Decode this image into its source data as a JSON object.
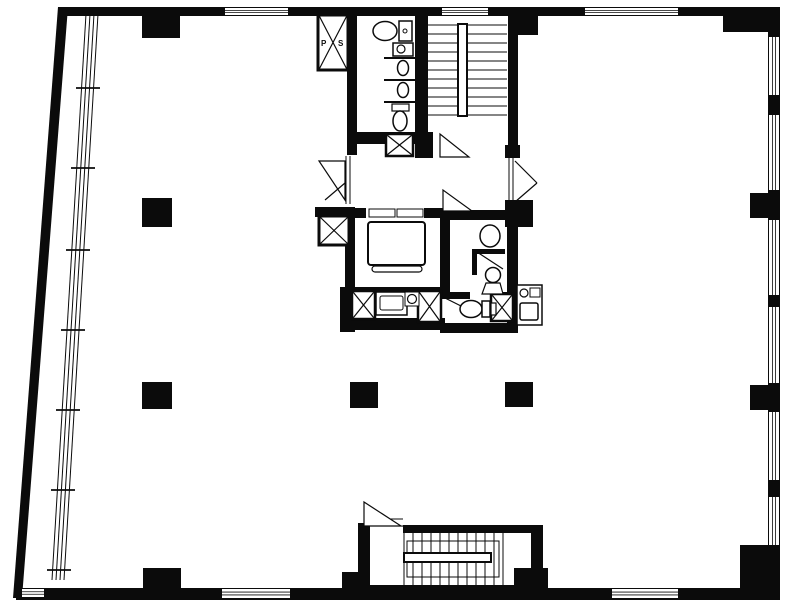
{
  "meta": {
    "title": "Office building floor plan",
    "kind": "architectural-floor-plan"
  },
  "canvas": {
    "width": 787,
    "height": 604,
    "paper": "#ffffff",
    "ink": "#0b0b0b"
  },
  "labels": {
    "shaft_p": "P",
    "shaft_s": "S"
  },
  "shapes": [
    {
      "t": "poly",
      "n": "left-exterior-wall",
      "pts": "58,7 68,7 22,598 13,598"
    },
    {
      "t": "rect",
      "n": "top-exterior-wall",
      "x": 58,
      "y": 7,
      "w": 722,
      "h": 9
    },
    {
      "t": "rect",
      "n": "right-exterior-wall",
      "x": 768,
      "y": 7,
      "w": 12,
      "h": 593
    },
    {
      "t": "rect",
      "n": "bottom-exterior-wall",
      "x": 16,
      "y": 588,
      "w": 764,
      "h": 12
    },
    {
      "t": "winh",
      "n": "window-top-1",
      "x": 225,
      "y": 8,
      "w": 63,
      "h": 7
    },
    {
      "t": "winh",
      "n": "window-top-2",
      "x": 442,
      "y": 8,
      "w": 46,
      "h": 7
    },
    {
      "t": "winh",
      "n": "window-top-3",
      "x": 585,
      "y": 8,
      "w": 93,
      "h": 7
    },
    {
      "t": "winh",
      "n": "window-bottom-1",
      "x": 222,
      "y": 589,
      "w": 68,
      "h": 9
    },
    {
      "t": "winh",
      "n": "window-bottom-2",
      "x": 612,
      "y": 589,
      "w": 66,
      "h": 9
    },
    {
      "t": "winh",
      "n": "window-bottom-corner",
      "x": 22,
      "y": 589,
      "w": 22,
      "h": 8
    },
    {
      "t": "winv",
      "n": "window-right-1",
      "x": 769,
      "y": 37,
      "w": 10,
      "h": 58
    },
    {
      "t": "winv",
      "n": "window-right-2",
      "x": 769,
      "y": 115,
      "w": 10,
      "h": 75
    },
    {
      "t": "winv",
      "n": "window-right-3",
      "x": 769,
      "y": 220,
      "w": 10,
      "h": 75
    },
    {
      "t": "winv",
      "n": "window-right-4",
      "x": 769,
      "y": 307,
      "w": 10,
      "h": 76
    },
    {
      "t": "winv",
      "n": "window-right-5",
      "x": 769,
      "y": 412,
      "w": 10,
      "h": 68
    },
    {
      "t": "winv",
      "n": "window-right-6",
      "x": 769,
      "y": 497,
      "w": 10,
      "h": 48
    },
    {
      "t": "rect",
      "n": "core-wall-left-upper",
      "x": 347,
      "y": 16,
      "w": 10,
      "h": 139
    },
    {
      "t": "rect",
      "n": "core-wall-wc-stair-divider",
      "x": 415,
      "y": 16,
      "w": 13,
      "h": 142
    },
    {
      "t": "rect",
      "n": "core-wall-stair-right",
      "x": 508,
      "y": 16,
      "w": 10,
      "h": 140
    },
    {
      "t": "rect",
      "n": "core-wall-wc-bottom",
      "x": 347,
      "y": 132,
      "w": 86,
      "h": 12
    },
    {
      "t": "rect",
      "n": "core-wall-stub-a",
      "x": 420,
      "y": 144,
      "w": 13,
      "h": 14
    },
    {
      "t": "rect",
      "n": "core-wall-stub-b",
      "x": 505,
      "y": 145,
      "w": 15,
      "h": 13
    },
    {
      "t": "rect",
      "n": "core-wall-cap-west",
      "x": 315,
      "y": 207,
      "w": 40,
      "h": 10
    },
    {
      "t": "rect",
      "n": "core-wall-left-lower",
      "x": 345,
      "y": 207,
      "w": 10,
      "h": 125
    },
    {
      "t": "rect",
      "n": "elevator-wall-top",
      "x": 345,
      "y": 208,
      "w": 105,
      "h": 10
    },
    {
      "t": "rect",
      "n": "elevator-wall-right",
      "x": 440,
      "y": 208,
      "w": 10,
      "h": 89
    },
    {
      "t": "rect",
      "n": "elevator-wall-bottom",
      "x": 345,
      "y": 287,
      "w": 105,
      "h": 10
    },
    {
      "t": "rect",
      "n": "washroom-wall-top",
      "x": 447,
      "y": 210,
      "w": 60,
      "h": 10
    },
    {
      "t": "rect",
      "n": "corridor-corner-column",
      "x": 505,
      "y": 200,
      "w": 28,
      "h": 27
    },
    {
      "t": "rect",
      "n": "core-wall-right-lower",
      "x": 507,
      "y": 203,
      "w": 11,
      "h": 130
    },
    {
      "t": "rect",
      "n": "core-wall-west-lower",
      "x": 340,
      "y": 287,
      "w": 13,
      "h": 45
    },
    {
      "t": "rect",
      "n": "core-wall-bottom-left",
      "x": 340,
      "y": 318,
      "w": 105,
      "h": 12
    },
    {
      "t": "rect",
      "n": "core-wall-bottom-right",
      "x": 440,
      "y": 323,
      "w": 78,
      "h": 10
    },
    {
      "t": "rect",
      "n": "washroom-partition-h",
      "x": 472,
      "y": 249,
      "w": 33,
      "h": 5
    },
    {
      "t": "rect",
      "n": "washroom-partition-v",
      "x": 472,
      "y": 249,
      "w": 5,
      "h": 26
    },
    {
      "t": "rect",
      "n": "toilet-room-wall-a",
      "x": 440,
      "y": 292,
      "w": 30,
      "h": 7
    },
    {
      "t": "rect",
      "n": "toilet-room-wall-b",
      "x": 490,
      "y": 292,
      "w": 28,
      "h": 7
    },
    {
      "t": "rect",
      "n": "stair-enclosure-wall-left",
      "x": 358,
      "y": 523,
      "w": 12,
      "h": 70
    },
    {
      "t": "rect",
      "n": "stair-enclosure-wall-top",
      "x": 403,
      "y": 525,
      "w": 140,
      "h": 8
    },
    {
      "t": "rect",
      "n": "stair-enclosure-wall-right",
      "x": 531,
      "y": 533,
      "w": 12,
      "h": 57
    },
    {
      "t": "rect",
      "n": "stair-enclosure-wall-bottom",
      "x": 358,
      "y": 585,
      "w": 185,
      "h": 8
    },
    {
      "t": "rect",
      "n": "column-top-a",
      "x": 142,
      "y": 16,
      "w": 38,
      "h": 22
    },
    {
      "t": "rect",
      "n": "column-top-b",
      "x": 508,
      "y": 16,
      "w": 30,
      "h": 19
    },
    {
      "t": "rect",
      "n": "corner-column-top-right",
      "x": 723,
      "y": 7,
      "w": 57,
      "h": 25
    },
    {
      "t": "rect",
      "n": "column-right-a",
      "x": 750,
      "y": 193,
      "w": 30,
      "h": 25
    },
    {
      "t": "rect",
      "n": "column-right-b",
      "x": 750,
      "y": 385,
      "w": 30,
      "h": 25
    },
    {
      "t": "rect",
      "n": "corner-column-bottom-right",
      "x": 740,
      "y": 545,
      "w": 40,
      "h": 55
    },
    {
      "t": "rect",
      "n": "column-free-left-a",
      "x": 142,
      "y": 198,
      "w": 30,
      "h": 29
    },
    {
      "t": "rect",
      "n": "column-free-left-b",
      "x": 142,
      "y": 382,
      "w": 30,
      "h": 27
    },
    {
      "t": "rect",
      "n": "column-free-center",
      "x": 350,
      "y": 382,
      "w": 28,
      "h": 26
    },
    {
      "t": "rect",
      "n": "column-free-right",
      "x": 505,
      "y": 382,
      "w": 28,
      "h": 25
    },
    {
      "t": "rect",
      "n": "column-bottom-a",
      "x": 143,
      "y": 568,
      "w": 38,
      "h": 22
    },
    {
      "t": "rect",
      "n": "column-bottom-stair-left",
      "x": 342,
      "y": 572,
      "w": 26,
      "h": 18
    },
    {
      "t": "rect",
      "n": "column-bottom-stair-right",
      "x": 514,
      "y": 568,
      "w": 34,
      "h": 22
    },
    {
      "t": "line",
      "n": "stair-tread",
      "x1": 428,
      "y1": 25,
      "x2": 507,
      "y2": 25,
      "sw": 1
    },
    {
      "t": "line",
      "n": "stair-tread",
      "x1": 428,
      "y1": 34,
      "x2": 507,
      "y2": 34,
      "sw": 1
    },
    {
      "t": "line",
      "n": "stair-tread",
      "x1": 428,
      "y1": 43,
      "x2": 507,
      "y2": 43,
      "sw": 1
    },
    {
      "t": "line",
      "n": "stair-tread",
      "x1": 428,
      "y1": 52,
      "x2": 507,
      "y2": 52,
      "sw": 1
    },
    {
      "t": "line",
      "n": "stair-tread",
      "x1": 428,
      "y1": 61,
      "x2": 507,
      "y2": 61,
      "sw": 1
    },
    {
      "t": "line",
      "n": "stair-tread",
      "x1": 428,
      "y1": 70,
      "x2": 507,
      "y2": 70,
      "sw": 1
    },
    {
      "t": "line",
      "n": "stair-tread",
      "x1": 428,
      "y1": 79,
      "x2": 507,
      "y2": 79,
      "sw": 1
    },
    {
      "t": "line",
      "n": "stair-tread",
      "x1": 428,
      "y1": 88,
      "x2": 507,
      "y2": 88,
      "sw": 1
    },
    {
      "t": "line",
      "n": "stair-tread",
      "x1": 428,
      "y1": 97,
      "x2": 507,
      "y2": 97,
      "sw": 1
    },
    {
      "t": "line",
      "n": "stair-tread",
      "x1": 428,
      "y1": 106,
      "x2": 507,
      "y2": 106,
      "sw": 1
    },
    {
      "t": "line",
      "n": "stair-tread",
      "x1": 428,
      "y1": 115,
      "x2": 507,
      "y2": 115,
      "sw": 1
    },
    {
      "t": "wrect",
      "n": "stair-rail-upper",
      "x": 458,
      "y": 24,
      "w": 9,
      "h": 92,
      "sw": 2
    },
    {
      "t": "wpoly",
      "n": "door-stair-landing",
      "pts": "440,134 440,157 469,157",
      "sw": 1.2
    },
    {
      "t": "orect",
      "n": "stair-flight-outline",
      "x": 407,
      "y": 541,
      "w": 92,
      "h": 36,
      "sw": 1
    },
    {
      "t": "line",
      "n": "stair-tread-lower",
      "x1": 404,
      "y1": 533,
      "x2": 404,
      "y2": 585,
      "sw": 1
    },
    {
      "t": "line",
      "n": "stair-tread-lower",
      "x1": 413,
      "y1": 533,
      "x2": 413,
      "y2": 585,
      "sw": 1
    },
    {
      "t": "line",
      "n": "stair-tread-lower",
      "x1": 422,
      "y1": 533,
      "x2": 422,
      "y2": 585,
      "sw": 1
    },
    {
      "t": "line",
      "n": "stair-tread-lower",
      "x1": 431,
      "y1": 533,
      "x2": 431,
      "y2": 585,
      "sw": 1
    },
    {
      "t": "line",
      "n": "stair-tread-lower",
      "x1": 440,
      "y1": 533,
      "x2": 440,
      "y2": 585,
      "sw": 1
    },
    {
      "t": "line",
      "n": "stair-tread-lower",
      "x1": 449,
      "y1": 533,
      "x2": 449,
      "y2": 585,
      "sw": 1
    },
    {
      "t": "line",
      "n": "stair-tread-lower",
      "x1": 458,
      "y1": 533,
      "x2": 458,
      "y2": 585,
      "sw": 1
    },
    {
      "t": "line",
      "n": "stair-tread-lower",
      "x1": 467,
      "y1": 533,
      "x2": 467,
      "y2": 585,
      "sw": 1
    },
    {
      "t": "line",
      "n": "stair-tread-lower",
      "x1": 476,
      "y1": 533,
      "x2": 476,
      "y2": 585,
      "sw": 1
    },
    {
      "t": "line",
      "n": "stair-tread-lower",
      "x1": 485,
      "y1": 533,
      "x2": 485,
      "y2": 585,
      "sw": 1
    },
    {
      "t": "line",
      "n": "stair-tread-lower",
      "x1": 494,
      "y1": 533,
      "x2": 494,
      "y2": 585,
      "sw": 1
    },
    {
      "t": "line",
      "n": "stair-tread-lower",
      "x1": 503,
      "y1": 533,
      "x2": 503,
      "y2": 585,
      "sw": 1
    },
    {
      "t": "wrect",
      "n": "stair-rail-lower",
      "x": 404,
      "y": 553,
      "w": 87,
      "h": 9,
      "sw": 2
    },
    {
      "t": "line",
      "n": "stair-door-sill",
      "x1": 366,
      "y1": 519,
      "x2": 403,
      "y2": 519,
      "sw": 1
    },
    {
      "t": "line",
      "n": "stair-door-sill",
      "x1": 366,
      "y1": 526,
      "x2": 403,
      "y2": 526,
      "sw": 1
    },
    {
      "t": "wpoly",
      "n": "door-stair-lower",
      "pts": "364,502 364,526 401,526",
      "sw": 1.2
    },
    {
      "t": "wrect",
      "n": "elevator-door-opening",
      "x": 366,
      "y": 208,
      "w": 58,
      "h": 10,
      "sw": 0
    },
    {
      "t": "orect",
      "n": "elevator-door-panel-left",
      "x": 369,
      "y": 209,
      "w": 26,
      "h": 8,
      "sw": 1
    },
    {
      "t": "orect",
      "n": "elevator-door-panel-right",
      "x": 397,
      "y": 209,
      "w": 26,
      "h": 8,
      "sw": 1
    },
    {
      "t": "wrect",
      "n": "elevator-car",
      "x": 368,
      "y": 222,
      "w": 57,
      "h": 43,
      "sw": 2,
      "rx": 3
    },
    {
      "t": "wrect",
      "n": "elevator-sill",
      "x": 372,
      "y": 266,
      "w": 50,
      "h": 6,
      "sw": 1.2,
      "rx": 3
    },
    {
      "t": "xbox",
      "n": "pipe-shaft-ps",
      "x": 318,
      "y": 15,
      "w": 30,
      "h": 55,
      "sw": 3
    },
    {
      "t": "xbox",
      "n": "duct-shaft-a",
      "x": 386,
      "y": 134,
      "w": 27,
      "h": 22,
      "sw": 2.5
    },
    {
      "t": "xbox",
      "n": "pipe-shaft-b",
      "x": 319,
      "y": 216,
      "w": 30,
      "h": 29,
      "sw": 3
    },
    {
      "t": "xbox",
      "n": "duct-shaft-c",
      "x": 352,
      "y": 291,
      "w": 23,
      "h": 28,
      "sw": 2.5
    },
    {
      "t": "xbox",
      "n": "duct-shaft-d",
      "x": 418,
      "y": 291,
      "w": 23,
      "h": 31,
      "sw": 2.5
    },
    {
      "t": "xbox",
      "n": "duct-shaft-e",
      "x": 491,
      "y": 294,
      "w": 22,
      "h": 27,
      "sw": 2.5
    },
    {
      "t": "text",
      "n": "shaft-label-p",
      "x": 321,
      "y": 46,
      "s": 8,
      "text": "P"
    },
    {
      "t": "text",
      "n": "shaft-label-s",
      "x": 338,
      "y": 46,
      "s": 8,
      "text": "S"
    },
    {
      "t": "ell",
      "n": "toilet-bowl-1",
      "cx": 385,
      "cy": 31,
      "rx": 12,
      "ry": 9.5,
      "sw": 1.5
    },
    {
      "t": "wrect",
      "n": "toilet-tank-1",
      "x": 399,
      "y": 21,
      "w": 13,
      "h": 20,
      "sw": 1.5
    },
    {
      "t": "circ",
      "n": "toilet-flush-1",
      "cx": 405,
      "cy": 31,
      "r": 2,
      "sw": 1
    },
    {
      "t": "wrect",
      "n": "lavatory-sink",
      "x": 393,
      "y": 43,
      "w": 20,
      "h": 13,
      "sw": 1.5
    },
    {
      "t": "circ",
      "n": "lavatory-basin",
      "cx": 401,
      "cy": 49,
      "r": 4,
      "sw": 1.2
    },
    {
      "t": "line",
      "n": "urinal-partition",
      "x1": 384,
      "y1": 58,
      "x2": 415,
      "y2": 58,
      "sw": 2
    },
    {
      "t": "ell",
      "n": "urinal-a",
      "cx": 403,
      "cy": 68,
      "rx": 5.5,
      "ry": 7.5,
      "sw": 1.5
    },
    {
      "t": "line",
      "n": "urinal-partition",
      "x1": 384,
      "y1": 80,
      "x2": 415,
      "y2": 80,
      "sw": 2
    },
    {
      "t": "ell",
      "n": "urinal-b",
      "cx": 403,
      "cy": 90,
      "rx": 5.5,
      "ry": 7.5,
      "sw": 1.5
    },
    {
      "t": "line",
      "n": "urinal-partition",
      "x1": 384,
      "y1": 102,
      "x2": 415,
      "y2": 102,
      "sw": 2
    },
    {
      "t": "wrect",
      "n": "toilet-tank-2",
      "x": 392,
      "y": 104,
      "w": 17,
      "h": 7,
      "sw": 1.2
    },
    {
      "t": "ell",
      "n": "toilet-bowl-2",
      "cx": 400,
      "cy": 121,
      "rx": 7,
      "ry": 10,
      "sw": 1.5
    },
    {
      "t": "ell",
      "n": "washbasin",
      "cx": 490,
      "cy": 236,
      "rx": 10,
      "ry": 11,
      "sw": 1.5
    },
    {
      "t": "line",
      "n": "door-leaf-washroom",
      "x1": 477,
      "y1": 252,
      "x2": 503,
      "y2": 269,
      "sw": 1.2
    },
    {
      "t": "circ",
      "n": "wc-front-bowl",
      "cx": 493,
      "cy": 275,
      "r": 7.5,
      "sw": 1.5
    },
    {
      "t": "wpoly",
      "n": "wc-front-base",
      "pts": "482,294 503,294 500,283 486,283",
      "sw": 1.2
    },
    {
      "t": "line",
      "n": "door-leaf-toilet",
      "x1": 441,
      "y1": 296,
      "x2": 467,
      "y2": 309,
      "sw": 1.2
    },
    {
      "t": "ell",
      "n": "toilet-bowl-3",
      "cx": 471,
      "cy": 309,
      "rx": 11,
      "ry": 8.5,
      "sw": 1.5
    },
    {
      "t": "wrect",
      "n": "toilet-tank-3",
      "x": 482,
      "y": 301,
      "w": 8,
      "h": 16,
      "sw": 1.5
    },
    {
      "t": "wrect",
      "n": "toilet-tank-3b",
      "x": 491,
      "y": 303,
      "w": 5,
      "h": 12,
      "sw": 1.2
    },
    {
      "t": "wrect",
      "n": "vanity-counter",
      "x": 376,
      "y": 292,
      "w": 31,
      "h": 23,
      "sw": 1.5
    },
    {
      "t": "orect",
      "n": "vanity-inner",
      "x": 380,
      "y": 296,
      "w": 23,
      "h": 14,
      "sw": 1,
      "rx": 2
    },
    {
      "t": "wrect",
      "n": "vanity-sink-box",
      "x": 405,
      "y": 292,
      "w": 14,
      "h": 14,
      "sw": 1
    },
    {
      "t": "circ",
      "n": "vanity-sink",
      "cx": 412,
      "cy": 299,
      "r": 4.5,
      "sw": 1.2
    },
    {
      "t": "wrect",
      "n": "kitchenette-unit",
      "x": 517,
      "y": 285,
      "w": 25,
      "h": 40,
      "sw": 1.5
    },
    {
      "t": "circ",
      "n": "kitchen-faucet",
      "cx": 524,
      "cy": 293,
      "r": 4,
      "sw": 1.2
    },
    {
      "t": "orect",
      "n": "kitchen-tray",
      "x": 530,
      "y": 288,
      "w": 10,
      "h": 9,
      "sw": 1
    },
    {
      "t": "wrect",
      "n": "kitchen-sink",
      "x": 520,
      "y": 303,
      "w": 18,
      "h": 17,
      "sw": 1.5,
      "rx": 2
    },
    {
      "t": "line",
      "n": "door-frame-west",
      "x1": 346,
      "y1": 156,
      "x2": 346,
      "y2": 204,
      "sw": 1
    },
    {
      "t": "line",
      "n": "door-frame-west",
      "x1": 350,
      "y1": 156,
      "x2": 350,
      "y2": 204,
      "sw": 1
    },
    {
      "t": "wpoly",
      "n": "door-west-leaf",
      "pts": "319,161 345,161 345,200",
      "sw": 1.2
    },
    {
      "t": "line",
      "n": "door-west-leaf-2",
      "x1": 325,
      "y1": 200,
      "x2": 345,
      "y2": 183,
      "sw": 1.2
    },
    {
      "t": "line",
      "n": "door-frame-east",
      "x1": 509,
      "y1": 158,
      "x2": 509,
      "y2": 203,
      "sw": 1
    },
    {
      "t": "line",
      "n": "door-frame-east",
      "x1": 513,
      "y1": 158,
      "x2": 513,
      "y2": 203,
      "sw": 1
    },
    {
      "t": "line",
      "n": "door-east-leaf",
      "x1": 515,
      "y1": 161,
      "x2": 537,
      "y2": 183,
      "sw": 1.2
    },
    {
      "t": "line",
      "n": "door-east-leaf",
      "x1": 515,
      "y1": 202,
      "x2": 537,
      "y2": 183,
      "sw": 1.2
    },
    {
      "t": "wpoly",
      "n": "door-lobby-leaf",
      "pts": "443,190 443,211 472,211",
      "sw": 1.2
    },
    {
      "t": "line",
      "n": "window-band-glazing",
      "x1": 86,
      "y1": 14,
      "x2": 52,
      "y2": 580,
      "sw": 1
    },
    {
      "t": "line",
      "n": "window-band-glazing",
      "x1": 90,
      "y1": 14,
      "x2": 56,
      "y2": 580,
      "sw": 1
    },
    {
      "t": "line",
      "n": "window-band-glazing",
      "x1": 94,
      "y1": 14,
      "x2": 60,
      "y2": 580,
      "sw": 1
    },
    {
      "t": "line",
      "n": "window-band-glazing",
      "x1": 98,
      "y1": 14,
      "x2": 64,
      "y2": 580,
      "sw": 1
    },
    {
      "t": "line",
      "n": "window-band-mullion",
      "x1": 76,
      "y1": 88,
      "x2": 100,
      "y2": 88,
      "sw": 1.8
    },
    {
      "t": "line",
      "n": "window-band-mullion",
      "x1": 71,
      "y1": 168,
      "x2": 95,
      "y2": 168,
      "sw": 1.8
    },
    {
      "t": "line",
      "n": "window-band-mullion",
      "x1": 66,
      "y1": 250,
      "x2": 90,
      "y2": 250,
      "sw": 1.8
    },
    {
      "t": "line",
      "n": "window-band-mullion",
      "x1": 61,
      "y1": 330,
      "x2": 85,
      "y2": 330,
      "sw": 1.8
    },
    {
      "t": "line",
      "n": "window-band-mullion",
      "x1": 56,
      "y1": 410,
      "x2": 80,
      "y2": 410,
      "sw": 1.8
    },
    {
      "t": "line",
      "n": "window-band-mullion",
      "x1": 51,
      "y1": 490,
      "x2": 75,
      "y2": 490,
      "sw": 1.8
    },
    {
      "t": "line",
      "n": "window-band-mullion",
      "x1": 47,
      "y1": 570,
      "x2": 71,
      "y2": 570,
      "sw": 1.8
    }
  ]
}
